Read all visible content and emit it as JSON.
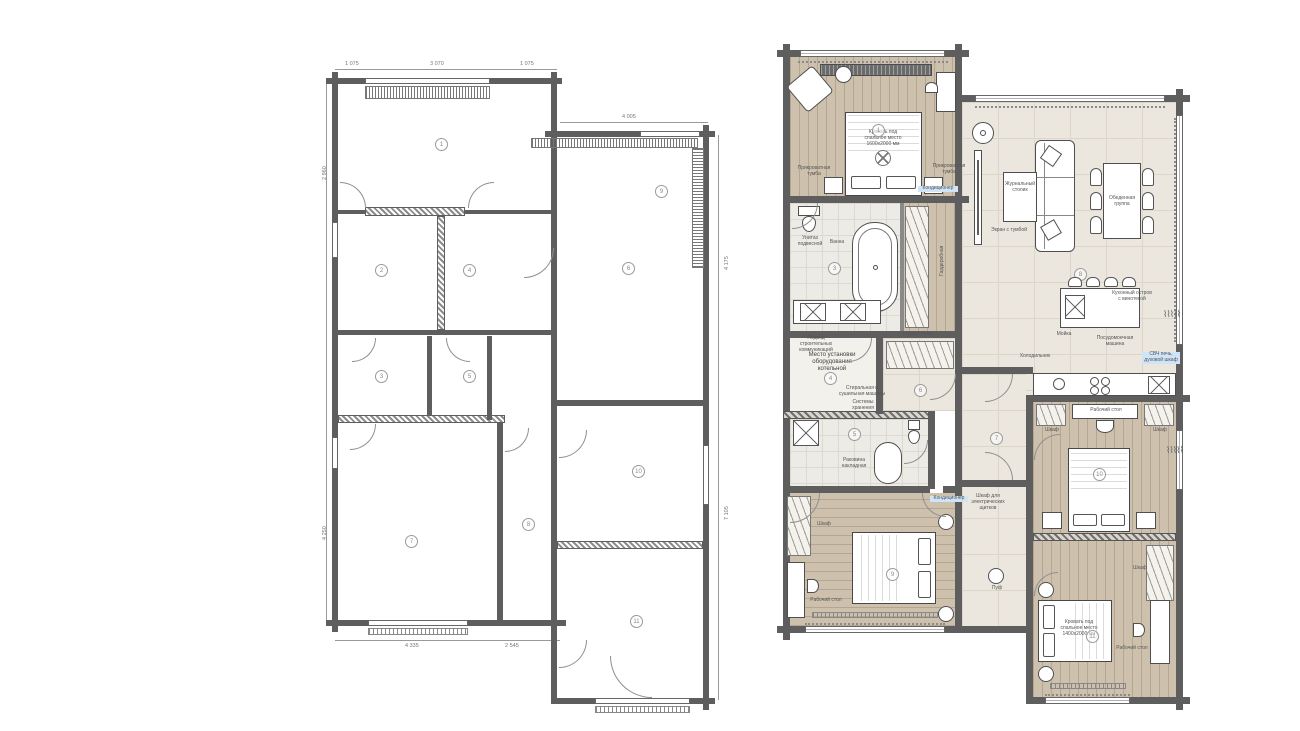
{
  "colors": {
    "wall": "#5e5e5e",
    "wood_floor": "#cdc1ae",
    "tile_floor": "#ebe7de",
    "bath_floor": "#edebe5",
    "label_highlight": "#cfe4f6",
    "line": "#8f8f8f"
  },
  "plan_left": {
    "type": "measurement-plan",
    "room_numbers": [
      "1",
      "2",
      "3",
      "4",
      "5",
      "6",
      "7",
      "8",
      "9",
      "10",
      "11"
    ],
    "dims_top": [
      "1 075",
      "3 070",
      "1 075"
    ],
    "dims_top2": [
      "4 005"
    ],
    "dims_bottom": [
      "4 335",
      "2 545"
    ],
    "dims_left": [
      "2 960",
      "4 250"
    ],
    "dims_right": [
      "4 175",
      "7 105"
    ]
  },
  "plan_right": {
    "type": "furniture-plan",
    "rooms": {
      "master": "1",
      "wardrobe": "2",
      "bath": "3",
      "utility": "4",
      "bath2": "5",
      "hall": "6",
      "corridor": "7",
      "living": "8",
      "bed2": "9",
      "bed3": "10",
      "bed4": "11"
    },
    "labels": {
      "master_bed": "Кровать под\nспальное место\n1600х2000 мм",
      "bed4_bed": "Кровать под\nспальное место\n1400х2000 мм",
      "nightstand": "Прикроватная\nтумба",
      "nightstand2": "Прикроватная\nтумба",
      "ac": "Кондиционер",
      "ac2": "Кондиционер",
      "tv": "Экран с тумбой",
      "coffee": "Журнальный\nстолик",
      "dining": "Обеденная\nгруппа",
      "island": "Кухонный остров\nс винотекой",
      "sink": "Мойка",
      "dishwasher": "Посудомоечная\nмашина",
      "oven": "СВЧ печь,\nдуховой шкаф",
      "fridge": "Холодильник",
      "bath": "Ванна",
      "toilet": "Унитаз\nподвесной",
      "basin": "Раковина\nнакладная",
      "boiler": "Место установки\nоборудования\nкотельной",
      "utilities": "Подвод\nстроительных\nкоммуникаций",
      "washer": "Стиральная и\nсушильная машины",
      "storage": "Системы\nхранения",
      "wardrobe": "Гардеробная",
      "wardrobe2": "Гардеробная",
      "closet_a": "Шкаф",
      "closet_b": "Шкаф",
      "closet_c": "Шкаф",
      "elec": "Шкаф для\nэлектрических\nщитков",
      "desk3": "Рабочий стол",
      "desk2": "Рабочий стол",
      "desk4": "Рабочий стол",
      "pouf": "Пуф"
    }
  }
}
